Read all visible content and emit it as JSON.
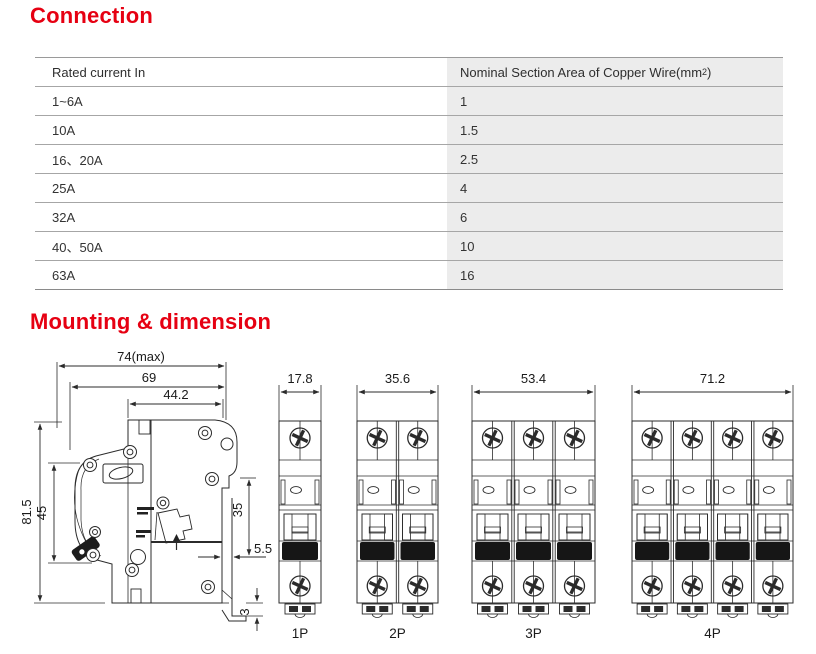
{
  "accent_color": "#e60012",
  "connection": {
    "title": "Connection",
    "table": {
      "col1_header": "Rated current In",
      "col2_header": "Nominal Section Area of Copper Wire(mm",
      "col2_header_sup": "2",
      "col2_header_tail": " )",
      "col2_bg": "#ececec",
      "rows": [
        {
          "current": "1~6A",
          "area": "1"
        },
        {
          "current": "10A",
          "area": "1.5"
        },
        {
          "current": "16、20A",
          "area": "2.5"
        },
        {
          "current": "25A",
          "area": "4"
        },
        {
          "current": "32A",
          "area": "6"
        },
        {
          "current": "40、50A",
          "area": "10"
        },
        {
          "current": "63A",
          "area": "16"
        }
      ]
    }
  },
  "mounting": {
    "title": "Mounting & dimension",
    "line_color": "#2b2b2b",
    "side_view": {
      "dim_width_max": "74(max)",
      "dim_width_69": "69",
      "dim_width_442": "44.2",
      "dim_height_815": "81.5",
      "dim_height_45": "45",
      "dim_rail_35": "35",
      "dim_gap_55": "5.5",
      "dim_hook_3": "3"
    },
    "front_views": [
      {
        "label": "1P",
        "width_dim": "17.8",
        "poles": 1
      },
      {
        "label": "2P",
        "width_dim": "35.6",
        "poles": 2
      },
      {
        "label": "3P",
        "width_dim": "53.4",
        "poles": 3
      },
      {
        "label": "4P",
        "width_dim": "71.2",
        "poles": 4
      }
    ]
  }
}
